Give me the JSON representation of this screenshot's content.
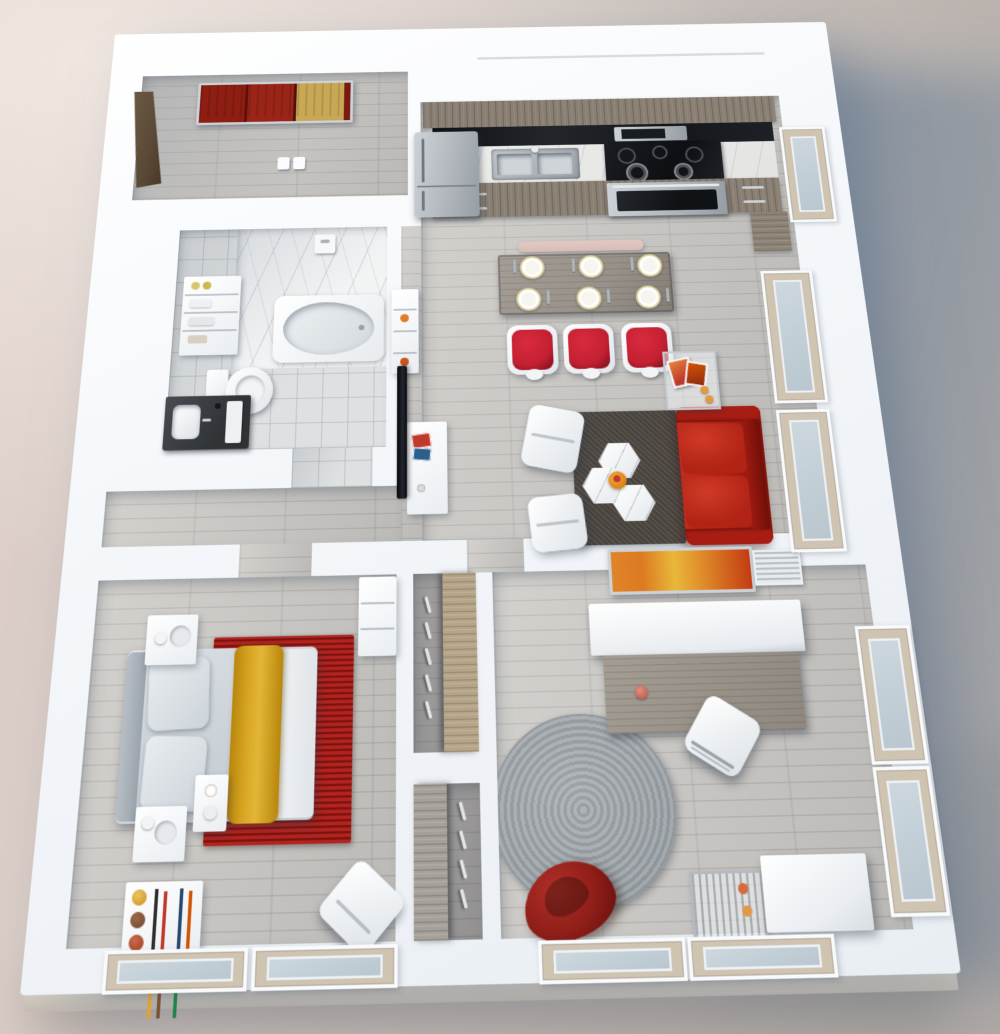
{
  "scene": {
    "type": "3d-floor-plan-render",
    "view": "top-down isometric",
    "description": "Photoreal 3D rendering of a one-bedroom plus den apartment floor plan on a neutral backdrop with a soft blue-grey cast shadow to the right",
    "rooms": [
      {
        "name": "entry",
        "items": [
          "front-door",
          "abstract-art-red-gold",
          "light-switches"
        ]
      },
      {
        "name": "kitchen",
        "items": [
          "refrigerator",
          "upper-cabinets",
          "black-backsplash",
          "microwave",
          "sink",
          "cooktop-5-burner",
          "oven",
          "base-cabinets",
          "pantry",
          "window"
        ]
      },
      {
        "name": "dining",
        "items": [
          "wood-table",
          "pink-bench",
          "red-chairs-x3",
          "place-settings-x6"
        ]
      },
      {
        "name": "living",
        "items": [
          "red-sofa",
          "dark-area-rug",
          "hex-coffee-tables-x3",
          "orange-tray",
          "white-lounge-chairs-x2",
          "glass-side-table",
          "magazines",
          "wall-tv",
          "media-console",
          "shelf-unit",
          "windows-x2"
        ]
      },
      {
        "name": "bathroom",
        "items": [
          "marble-shower-surround",
          "bathtub",
          "shower-valve",
          "towel-shelves",
          "toilet",
          "dark-vanity",
          "tile-floor"
        ]
      },
      {
        "name": "bedroom",
        "items": [
          "double-bed",
          "grey-pillows-x2",
          "yellow-throw",
          "red-woven-rug",
          "nightstands-x2",
          "coffee-tray-table",
          "dresser",
          "bookshelf-with-vases",
          "accent-chair",
          "windows-x2"
        ]
      },
      {
        "name": "den",
        "items": [
          "desk",
          "white-hutch",
          "orange-abstract-art",
          "vent-grille",
          "desk-chair",
          "round-grey-rug",
          "red-bean-bag",
          "metal-cart",
          "white-cabinet",
          "windows-x4"
        ]
      },
      {
        "name": "closets",
        "items": [
          "sliding-wood-panel",
          "hangers"
        ]
      }
    ],
    "counts": {
      "dining_chairs": 3,
      "place_settings": 6,
      "hex_tables": 3,
      "lounge_chairs": 2,
      "closets": 2
    }
  },
  "palette": {
    "bgLight": "#decfc8",
    "bgDark": "#b0aaa6",
    "castShadow": "#6f88a0",
    "wall": "#f4f7fa",
    "slab": "#dad2c6",
    "floorWood": "#c3c0bb",
    "plank": "#b1aea9",
    "tile": "#d8dbdc",
    "marble": "#edeff0",
    "cabinetWood": "#897f73",
    "counter": "#e4e4e2",
    "steel": "#b6bcc1",
    "applianceBlack": "#17191c",
    "tableWood": "#97918a",
    "benchPink": "#d9bcb6",
    "chairRed": "#c42032",
    "sofaRed": "#b02016",
    "rugBrown": "#57504a",
    "rugRed": "#a31d18",
    "rugGray": "#9aa1a6",
    "throwYellow": "#d7a422",
    "artRed": "#8e1d12",
    "artGold": "#c9a855",
    "artOrange": "#dd7a22",
    "doorWood": "#5a4936",
    "closetWood": "#b5a488",
    "glass": "#b9c6cf",
    "sill": "#cfc3b2",
    "beanbag": "#8e1d18"
  }
}
